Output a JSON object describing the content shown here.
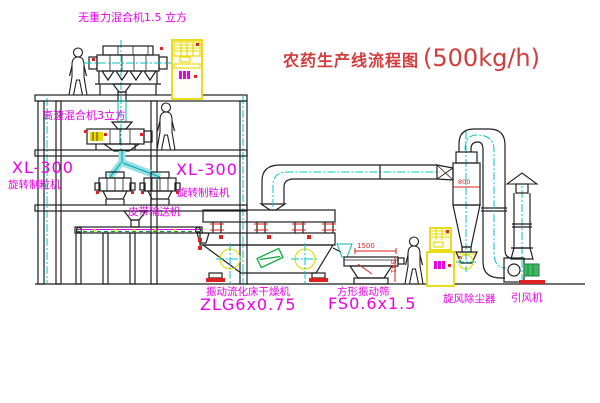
{
  "title": {
    "cn": "农药生产线流程图",
    "capacity": "(500kg/h)"
  },
  "labels": {
    "gravity_mixer": "无重力混合机1.5 立方",
    "speed_mixer": "高速混合机3立方",
    "granulator_left_model": "XL-300",
    "granulator_left_name": "旋转制粒机",
    "granulator_mid_model": "XL-300",
    "granulator_mid_name": "旋转制粒机",
    "belt_conveyor": "皮带输送机",
    "dryer_name": "振动流化床干燥机",
    "dryer_model": "ZLG6x0.75",
    "screen_name": "方形振动筛",
    "screen_model": "FS0.6x1.5",
    "cyclone": "旋风除尘器",
    "fan": "引风机"
  },
  "dimensions": {
    "screen_length": "1500",
    "screen_height": "341",
    "cyclone_dia": "800"
  },
  "colors": {
    "label_magenta": "#e800e8",
    "title_red": "#d23c3c",
    "dim_red": "#dd2222",
    "pipe_cyan": "#00b8b8",
    "cabinet_yellow": "#e8d800",
    "motor_green": "#00a830",
    "line_black": "#1f1f1f"
  }
}
